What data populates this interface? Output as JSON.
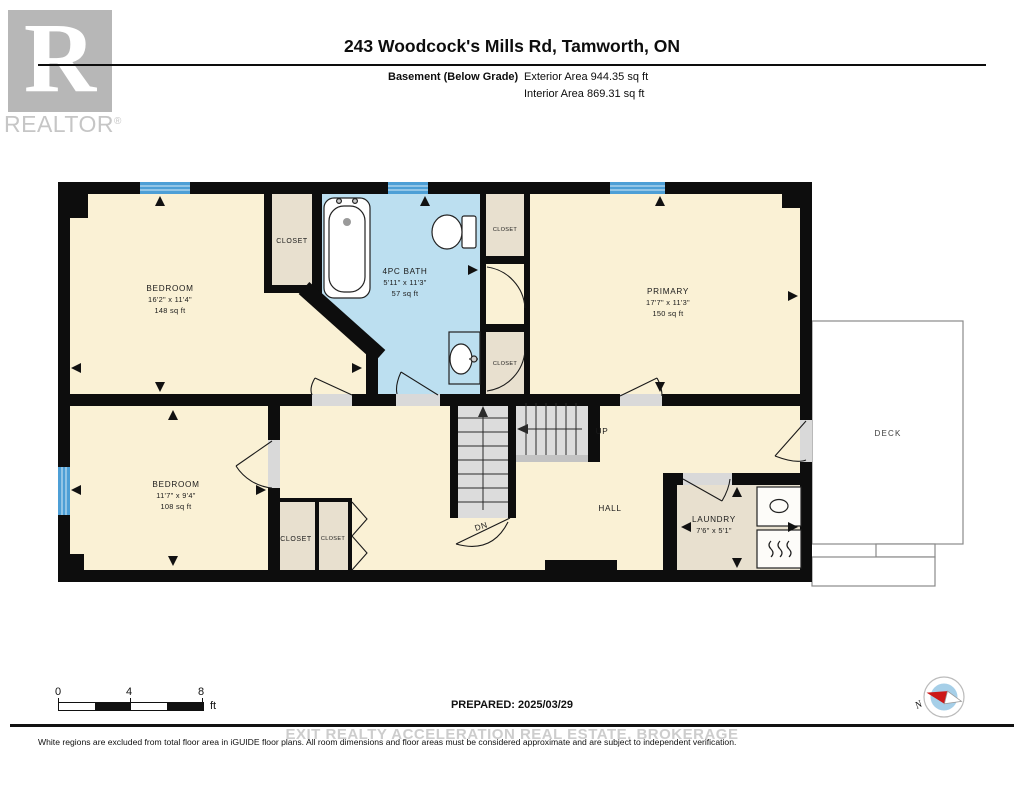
{
  "header": {
    "logo": {
      "letter": "R",
      "brand": "REALTOR",
      "registered": "®"
    },
    "title": "243 Woodcock's Mills Rd, Tamworth, ON",
    "floor_label": "Basement (Below Grade)",
    "exterior_area": "Exterior Area 944.35 sq ft",
    "interior_area": "Interior Area 869.31 sq ft"
  },
  "plan": {
    "bedroom1": {
      "name": "BEDROOM",
      "dims": "16'2\" x 11'4\"",
      "area": "148 sq ft"
    },
    "bath": {
      "name": "4PC BATH",
      "dims": "5'11\" x 11'3\"",
      "area": "57 sq ft"
    },
    "primary": {
      "name": "PRIMARY",
      "dims": "17'7\" x 11'3\"",
      "area": "150 sq ft"
    },
    "bedroom2": {
      "name": "BEDROOM",
      "dims": "11'7\" x 9'4\"",
      "area": "108 sq ft"
    },
    "laundry": {
      "name": "LAUNDRY",
      "dims": "7'6\" x 5'1\""
    },
    "hall": "HALL",
    "up": "UP",
    "down": "DN",
    "deck": "DECK",
    "closets": {
      "bedroom1": "CLOSET",
      "bath_upper": "CLOSET",
      "bath_lower": "CLOSET",
      "hall_left": "CLOSET",
      "hall_right": "CLOSET"
    }
  },
  "scale_bar": {
    "ticks": [
      "0",
      "4",
      "8"
    ],
    "unit": "ft"
  },
  "compass": {
    "north": "N"
  },
  "footer": {
    "prepared": "PREPARED: 2025/03/29",
    "watermark": "EXIT REALTY ACCELERATION REAL ESTATE, BROKERAGE",
    "disclaimer": "White regions are excluded from total floor area in iGUIDE floor plans. All room dimensions and floor areas must be considered approximate and are subject to independent verification."
  },
  "colors": {
    "room_fill": "#FAF1D5",
    "closet_fill": "#E8E0CF",
    "bath_fill": "#BCDFF0",
    "window_blue": "#4D9FD6",
    "wall": "#0d0d0d",
    "stairs": "#DCDCDC",
    "threshold": "#D9D9D9",
    "compass_inner": "#A6CFE8",
    "needle_red": "#CC1818"
  }
}
